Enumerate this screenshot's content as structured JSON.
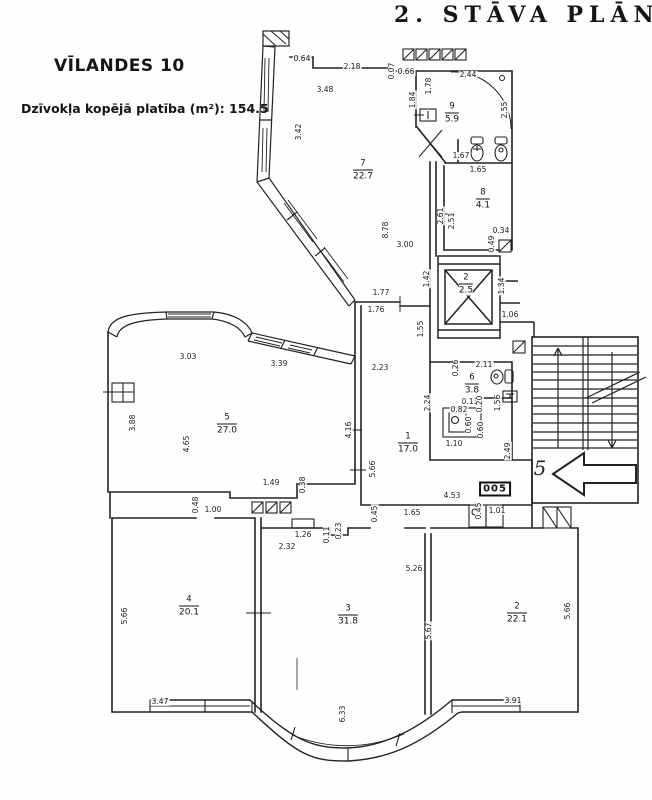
{
  "header": {
    "title": "2. STĀVA PLĀNA"
  },
  "info": {
    "building": "VĪLANDES 10",
    "area_label": "Dzīvokļa kopējā platība (m²):  154.5"
  },
  "plan": {
    "apartment_number": "005",
    "entrance_arrow_label": "5",
    "symbols": [
      "elevator-shaft-icon",
      "staircase-icon",
      "toilet-icon",
      "sink-icon",
      "stove-icon",
      "entrance-arrow-icon",
      "door-swing-icon",
      "window-icon",
      "hatched-square-icon"
    ],
    "rooms": [
      {
        "number": "7",
        "area": "22.7",
        "x": 363,
        "y": 170
      },
      {
        "number": "9",
        "area": "5.9",
        "x": 452,
        "y": 113
      },
      {
        "number": "8",
        "area": "4.1",
        "x": 483,
        "y": 199
      },
      {
        "number": "2",
        "area": "2.5",
        "x": 466,
        "y": 284
      },
      {
        "number": "6",
        "area": "3.8",
        "x": 472,
        "y": 384
      },
      {
        "number": "5",
        "area": "27.0",
        "x": 227,
        "y": 424
      },
      {
        "number": "1",
        "area": "17.0",
        "x": 408,
        "y": 443
      },
      {
        "number": "4",
        "area": "20.1",
        "x": 189,
        "y": 606
      },
      {
        "number": "3",
        "area": "31.8",
        "x": 348,
        "y": 615
      },
      {
        "number": "2",
        "area": "22.1",
        "x": 517,
        "y": 613
      }
    ],
    "dimensions": [
      {
        "v": "0.64",
        "x": 302,
        "y": 59,
        "o": "h"
      },
      {
        "v": "2.18",
        "x": 352,
        "y": 67,
        "o": "h"
      },
      {
        "v": "3.48",
        "x": 325,
        "y": 90,
        "o": "h"
      },
      {
        "v": "0.07",
        "x": 392,
        "y": 71,
        "o": "v"
      },
      {
        "v": "0.66",
        "x": 406,
        "y": 72,
        "o": "h"
      },
      {
        "v": "1.84",
        "x": 413,
        "y": 100,
        "o": "v"
      },
      {
        "v": "1.78",
        "x": 429,
        "y": 86,
        "o": "v"
      },
      {
        "v": "2.44",
        "x": 468,
        "y": 75,
        "o": "h"
      },
      {
        "v": "2.55",
        "x": 505,
        "y": 110,
        "o": "v"
      },
      {
        "v": "3.42",
        "x": 299,
        "y": 132,
        "o": "v"
      },
      {
        "v": "1.67",
        "x": 461,
        "y": 156,
        "o": "h"
      },
      {
        "v": "1.65",
        "x": 478,
        "y": 170,
        "o": "h"
      },
      {
        "v": "8.78",
        "x": 386,
        "y": 230,
        "o": "v"
      },
      {
        "v": "3.00",
        "x": 405,
        "y": 245,
        "o": "h"
      },
      {
        "v": "2.61",
        "x": 441,
        "y": 216,
        "o": "v"
      },
      {
        "v": "2.51",
        "x": 452,
        "y": 221,
        "o": "v"
      },
      {
        "v": "0.34",
        "x": 501,
        "y": 231,
        "o": "h"
      },
      {
        "v": "0.49",
        "x": 492,
        "y": 244,
        "o": "v"
      },
      {
        "v": "1.42",
        "x": 427,
        "y": 279,
        "o": "v"
      },
      {
        "v": "1.34",
        "x": 502,
        "y": 286,
        "o": "v"
      },
      {
        "v": "1.06",
        "x": 510,
        "y": 315,
        "o": "h"
      },
      {
        "v": "1.77",
        "x": 381,
        "y": 293,
        "o": "h"
      },
      {
        "v": "1.76",
        "x": 376,
        "y": 310,
        "o": "h"
      },
      {
        "v": "1.55",
        "x": 421,
        "y": 329,
        "o": "v"
      },
      {
        "v": "3.03",
        "x": 188,
        "y": 357,
        "o": "h"
      },
      {
        "v": "3.39",
        "x": 279,
        "y": 364,
        "o": "h"
      },
      {
        "v": "2.23",
        "x": 380,
        "y": 368,
        "o": "h"
      },
      {
        "v": "2.11",
        "x": 484,
        "y": 365,
        "o": "h"
      },
      {
        "v": "0.26",
        "x": 456,
        "y": 368,
        "o": "v"
      },
      {
        "v": "2.24",
        "x": 428,
        "y": 403,
        "o": "v"
      },
      {
        "v": "0.82",
        "x": 459,
        "y": 410,
        "o": "h"
      },
      {
        "v": "0.13",
        "x": 470,
        "y": 402,
        "o": "h"
      },
      {
        "v": "0.20",
        "x": 480,
        "y": 404,
        "o": "v"
      },
      {
        "v": "1.56",
        "x": 498,
        "y": 403,
        "o": "v"
      },
      {
        "v": "0.60",
        "x": 469,
        "y": 425,
        "o": "v"
      },
      {
        "v": "0.60",
        "x": 481,
        "y": 430,
        "o": "v"
      },
      {
        "v": "1.10",
        "x": 454,
        "y": 444,
        "o": "h"
      },
      {
        "v": "3.88",
        "x": 133,
        "y": 423,
        "o": "v"
      },
      {
        "v": "4.65",
        "x": 187,
        "y": 444,
        "o": "v"
      },
      {
        "v": "4.16",
        "x": 349,
        "y": 430,
        "o": "v"
      },
      {
        "v": "5.66",
        "x": 373,
        "y": 469,
        "o": "v"
      },
      {
        "v": "2.49",
        "x": 508,
        "y": 451,
        "o": "v"
      },
      {
        "v": "1.49",
        "x": 271,
        "y": 483,
        "o": "h"
      },
      {
        "v": "0.38",
        "x": 303,
        "y": 485,
        "o": "v"
      },
      {
        "v": "4.53",
        "x": 452,
        "y": 496,
        "o": "h"
      },
      {
        "v": "0.45",
        "x": 375,
        "y": 514,
        "o": "v"
      },
      {
        "v": "1.65",
        "x": 412,
        "y": 513,
        "o": "h"
      },
      {
        "v": "0.45",
        "x": 479,
        "y": 511,
        "o": "v"
      },
      {
        "v": "1.01",
        "x": 497,
        "y": 511,
        "o": "h"
      },
      {
        "v": "0.48",
        "x": 196,
        "y": 505,
        "o": "v"
      },
      {
        "v": "1.00",
        "x": 213,
        "y": 510,
        "o": "h"
      },
      {
        "v": "1.26",
        "x": 303,
        "y": 535,
        "o": "h"
      },
      {
        "v": "0.11",
        "x": 327,
        "y": 535,
        "o": "v"
      },
      {
        "v": "0.23",
        "x": 339,
        "y": 531,
        "o": "v"
      },
      {
        "v": "2.32",
        "x": 287,
        "y": 547,
        "o": "h"
      },
      {
        "v": "5.26",
        "x": 414,
        "y": 569,
        "o": "h"
      },
      {
        "v": "5.66",
        "x": 125,
        "y": 616,
        "o": "v"
      },
      {
        "v": "5.67",
        "x": 429,
        "y": 631,
        "o": "v"
      },
      {
        "v": "5.66",
        "x": 568,
        "y": 611,
        "o": "v"
      },
      {
        "v": "3.47",
        "x": 160,
        "y": 702,
        "o": "h"
      },
      {
        "v": "6.33",
        "x": 343,
        "y": 714,
        "o": "v"
      },
      {
        "v": "3.91",
        "x": 513,
        "y": 701,
        "o": "h"
      }
    ]
  },
  "colors": {
    "ink": "#1f1f1f",
    "paper": "#ffffff"
  }
}
